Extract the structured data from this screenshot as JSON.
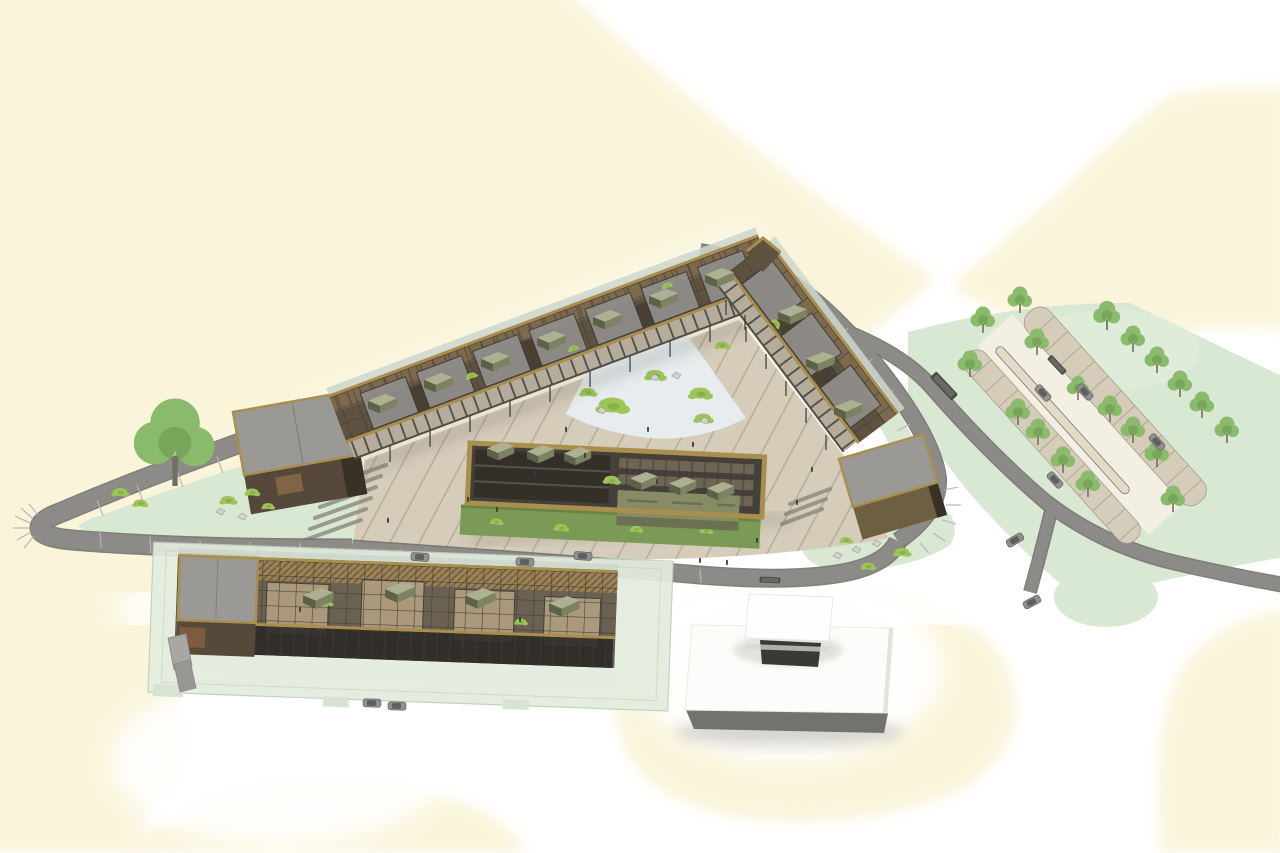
{
  "meta": {
    "title": "Aerial axonometric architectural rendering of a triangular courtyard building complex",
    "type": "3d-site-plan-rendering",
    "image_text": []
  },
  "palette": {
    "bg": "#ffffff",
    "cream": "#faf4da",
    "mint": "#d9e8d3",
    "mintLight": "#e6f0e1",
    "mintEdge": "#c0d3ba",
    "road": "#8c8b87",
    "roadDark": "#6b6a66",
    "roadTick": "#b8b6b1",
    "beige": "#d6ccba",
    "beigeLine": "#a69d8a",
    "aisle": "#f3efe3",
    "median": "#e2d9c5",
    "stair": "#8b887e",
    "ice": "#e7edef",
    "splotch": "#9cc456",
    "splotchDark": "#74a341",
    "tree": "#8abb6d",
    "treeDark": "#5f8f45",
    "trunk": "#6f6f60",
    "gold": "#a98f4e",
    "brown": "#5e5140",
    "brownDark": "#383226",
    "beam": "#403e39",
    "glass": "#ccd6cc",
    "courtFloor": "#908e8a",
    "floorWood": "#b3a080",
    "boxTop": "#adb191",
    "boxFront": "#7d8263",
    "boxSide": "#5c6147",
    "facade": "#b5ac9b",
    "post": "#3a3a37",
    "lawn": "#7b9a55",
    "roofGrey": "#9b9996",
    "wallBrown": "#55483a",
    "oliveWall": "#6d5f41",
    "plinth": "#e3ecdf",
    "plinthEdge": "#bed0b9",
    "white": "#ffffff",
    "whiteBldg": "#fcfcfa",
    "baseGrey": "#727270",
    "opening": "#3a3936",
    "carBody": "#909090",
    "carDark": "#565656",
    "busBody": "#4c4c4a",
    "rock": "#d3d3ce",
    "rockEdge": "#9b9b96",
    "wood": "#9c8256",
    "woodLine": "#6f5a3c",
    "arcade": "#2c2a26",
    "shadow": "#4a443a"
  },
  "scene": {
    "background": {
      "base": "white",
      "patches": "soft cream blobs",
      "cream_patch_count": 6
    },
    "buildings": [
      {
        "name": "main-v-building",
        "desc": "V-shaped two-wing gallery building with rooftop grid, open courts and rooftop box volumes",
        "rooftop_boxes": 10
      },
      {
        "name": "central-pavilion",
        "desc": "gold-framed pavilion in the plaza with lawn strip and olive annex",
        "rooftop_boxes": 6
      },
      {
        "name": "linear-building",
        "desc": "long low building on pale-green glass plinth at the south-west",
        "rooftop_boxes": 4
      },
      {
        "name": "white-building",
        "desc": "white flat-roofed building with raised white penthouse volume and dark base",
        "rooftop_boxes": 1
      }
    ],
    "landscape": {
      "teardrop_plaza_trees": 1,
      "parking_trees": 19,
      "parking_rows": 2,
      "roundabout": 1,
      "ice_plaza_green_patches": 6,
      "ice_plaza_rocks": 4
    },
    "vehicles": {
      "cars": 11,
      "buses": 2,
      "trucks": 1
    },
    "people": 18
  }
}
